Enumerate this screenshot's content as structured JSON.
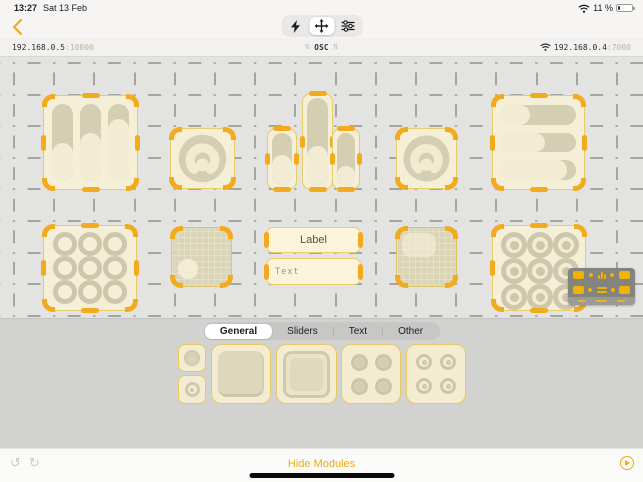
{
  "status": {
    "time": "13:27",
    "date": "Sat 13 Feb",
    "battery": "11 %"
  },
  "toolbar": {
    "back_icon": "chevron-left",
    "modes": [
      {
        "name": "play-mode",
        "icon": "lightning-bolt",
        "selected": false
      },
      {
        "name": "move-mode",
        "icon": "move-arrows",
        "selected": true
      },
      {
        "name": "edit-mode",
        "icon": "sliders",
        "selected": false
      }
    ]
  },
  "osc": {
    "local_host": "192.168.0.5",
    "local_port": ":10000",
    "protocol": "OSC",
    "remote_host": "192.168.0.4",
    "remote_port": ":7000"
  },
  "canvas": {
    "label_widget_text": "Label",
    "text_widget_text": "Text",
    "fader_group_values": {
      "0": 50,
      "1": 62,
      "2": 80
    },
    "fader_values": {
      "0": 58,
      "1": 45,
      "2": 36
    },
    "hslider_values": {
      "0": 38,
      "1": 58,
      "2": 88
    }
  },
  "palette": {
    "tabs": [
      {
        "label": "General",
        "selected": true
      },
      {
        "label": "Sliders",
        "selected": false
      },
      {
        "label": "Text",
        "selected": false
      },
      {
        "label": "Other",
        "selected": false
      }
    ]
  },
  "bottom": {
    "hide_modules": "Hide Modules"
  },
  "colors": {
    "accent_orange": "#f3ab1e",
    "accent_yellow": "#eead0b",
    "widget_cream": "#f6efd8",
    "widget_tan": "#d4ceb2"
  }
}
